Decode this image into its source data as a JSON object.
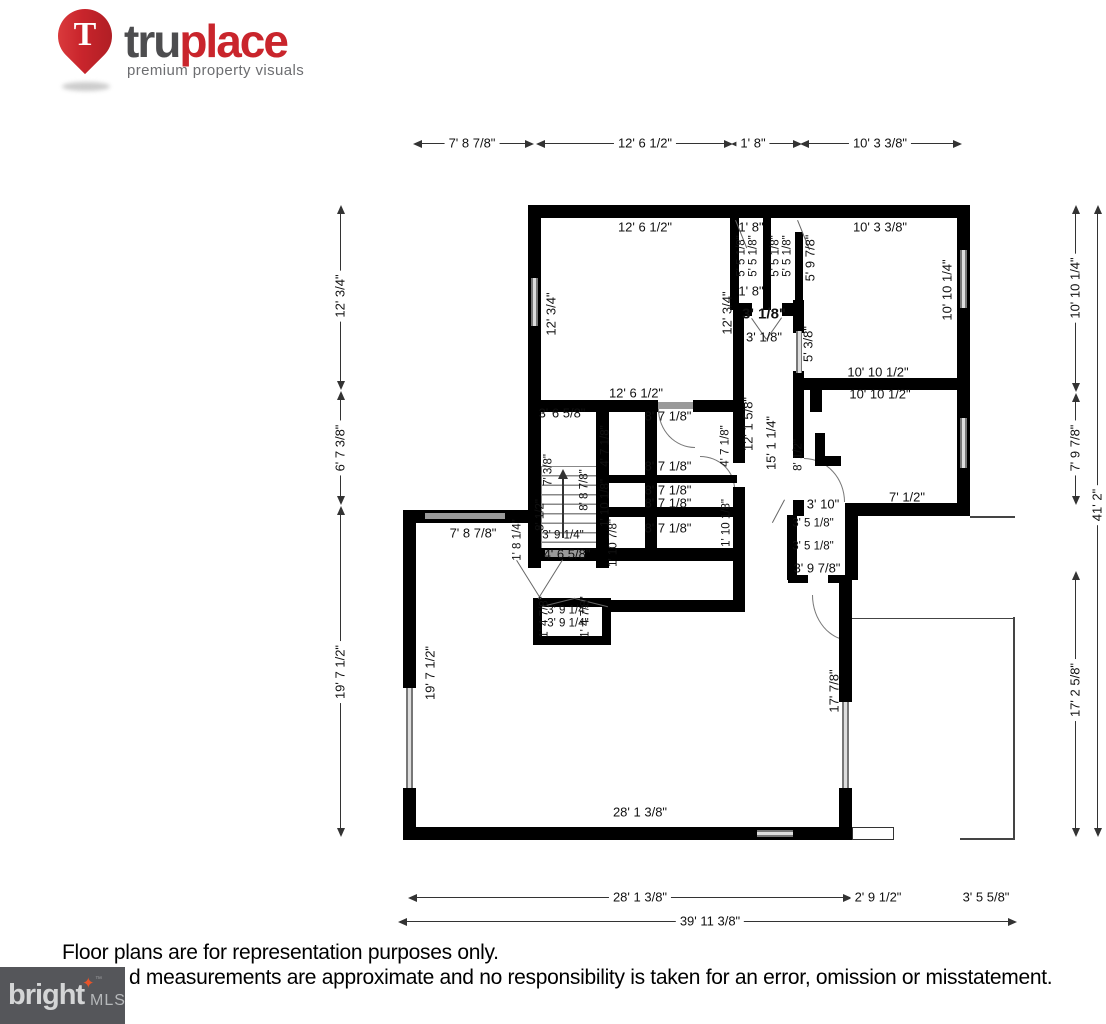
{
  "logo": {
    "pin_letter": "T",
    "brand_tru": "tru",
    "brand_place": "place",
    "tagline": "premium property visuals"
  },
  "colors": {
    "truplace_red": "#c9252c",
    "logo_dark_gray": "#4d4d4f",
    "tagline_gray": "#6d6e71",
    "wall_black": "#000000",
    "window_gray": "#8f8f8f",
    "bright_box_gray": "#55565a",
    "bright_star_orange": "#e8542a"
  },
  "disclaimer": {
    "line1": "Floor plans are for representation purposes only.",
    "line2": "d measurements are approximate and no responsibility is taken for an error, omission or misstatement."
  },
  "bright_mls": {
    "brand": "bright",
    "tm": "™",
    "suffix": "MLS"
  },
  "dims": [
    {
      "t": "7' 8 7/8\""
    },
    {
      "t": "12' 6 1/2\""
    },
    {
      "t": "1' 8\""
    },
    {
      "t": "10' 3 3/8\""
    },
    {
      "t": "12' 3/4\""
    },
    {
      "t": "6' 7 3/8\""
    },
    {
      "t": "19' 7 1/2\""
    },
    {
      "t": "10' 10 1/4\""
    },
    {
      "t": "7' 9 7/8\""
    },
    {
      "t": "17' 2 5/8\""
    },
    {
      "t": "41' 2\""
    },
    {
      "t": "28' 1 3/8\""
    },
    {
      "t": "2' 9 1/2\""
    },
    {
      "t": "3' 5 5/8\""
    },
    {
      "t": "39' 11 3/8\""
    },
    {
      "t": "12' 6 1/2\""
    },
    {
      "t": "1' 8\""
    },
    {
      "t": "10' 3 3/8\""
    },
    {
      "t": "12' 3/4\""
    },
    {
      "t": "12' 3/4\""
    },
    {
      "t": "5' 5 1/8\""
    },
    {
      "t": "5' 5 1/8\""
    },
    {
      "t": "5' 5 1/8\""
    },
    {
      "t": "5' 5 1/8\""
    },
    {
      "t": "5' 9 7/8\""
    },
    {
      "t": "1' 8\""
    },
    {
      "t": "3' 1/8\""
    },
    {
      "t": "3' 1/8\""
    },
    {
      "t": "5' 3/8\""
    },
    {
      "t": "10' 10 1/4\""
    },
    {
      "t": "10' 10 1/2\""
    },
    {
      "t": "10' 10 1/2\""
    },
    {
      "t": "12' 6 1/2\""
    },
    {
      "t": "3' 6 5/8\""
    },
    {
      "t": "8' 7 1/8\""
    },
    {
      "t": "4' 7 1/8\""
    },
    {
      "t": "4' 7 1/8\""
    },
    {
      "t": "12' 1 5/8\""
    },
    {
      "t": "15' 1 1/4\""
    },
    {
      "t": "8' 1/2\""
    },
    {
      "t": "7' 3/8\""
    },
    {
      "t": "8' 8 7/8\""
    },
    {
      "t": "8' 7 1/8\""
    },
    {
      "t": "8' 7 1/8\""
    },
    {
      "t": "8' 7 1/8\""
    },
    {
      "t": "8' 7 1/8\""
    },
    {
      "t": "1' 10 1/8\""
    },
    {
      "t": "1' 10 7/8\""
    },
    {
      "t": "1' 10 1/8\""
    },
    {
      "t": "7' 8 7/8\""
    },
    {
      "t": "1' 8 1/4\""
    },
    {
      "t": "8' 1/2\""
    },
    {
      "t": "3' 9 1/4\""
    },
    {
      "t": "4' 6 5/8\""
    },
    {
      "t": "3' 10\""
    },
    {
      "t": "7' 1/2\""
    },
    {
      "t": "3' 5 1/8\""
    },
    {
      "t": "3' 5 1/8\""
    },
    {
      "t": "3' 9 7/8\""
    },
    {
      "t": "3' 9 1/4\""
    },
    {
      "t": "3' 9 1/4\""
    },
    {
      "t": "1' 4 7/8\""
    },
    {
      "t": "1' 4 7/8\""
    },
    {
      "t": "19' 7 1/2\""
    },
    {
      "t": "17' 7/8\""
    },
    {
      "t": "28' 1 3/8\""
    }
  ]
}
